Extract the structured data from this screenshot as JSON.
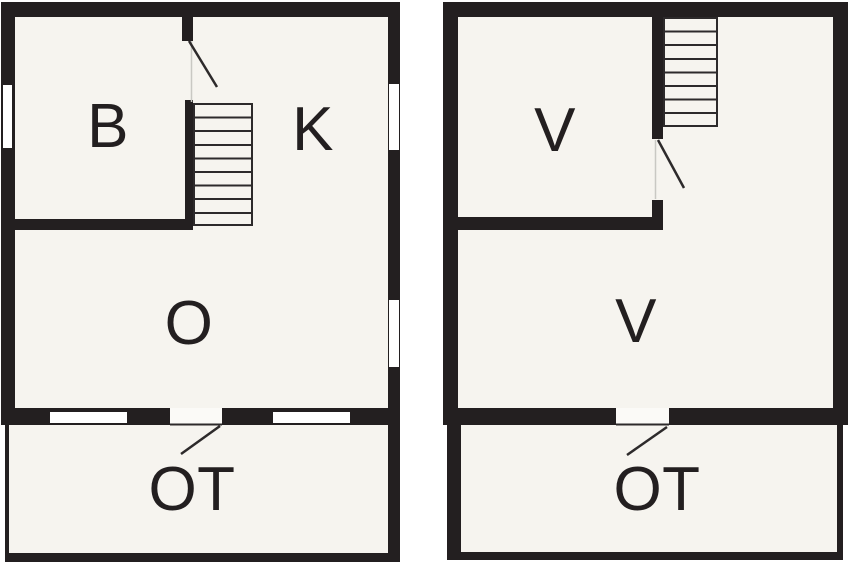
{
  "colors": {
    "wall": "#231f20",
    "floor": "#f6f4ef",
    "background": "#ffffff",
    "stair_and_door_line": "#2d2a2b"
  },
  "ground_floor": {
    "rooms": [
      {
        "label": "B"
      },
      {
        "label": "K"
      },
      {
        "label": "O"
      }
    ],
    "terrace": {
      "label": "OT"
    }
  },
  "upper_floor": {
    "rooms": [
      {
        "label": "V"
      },
      {
        "label": "V"
      }
    ],
    "terrace": {
      "label": "OT"
    }
  }
}
